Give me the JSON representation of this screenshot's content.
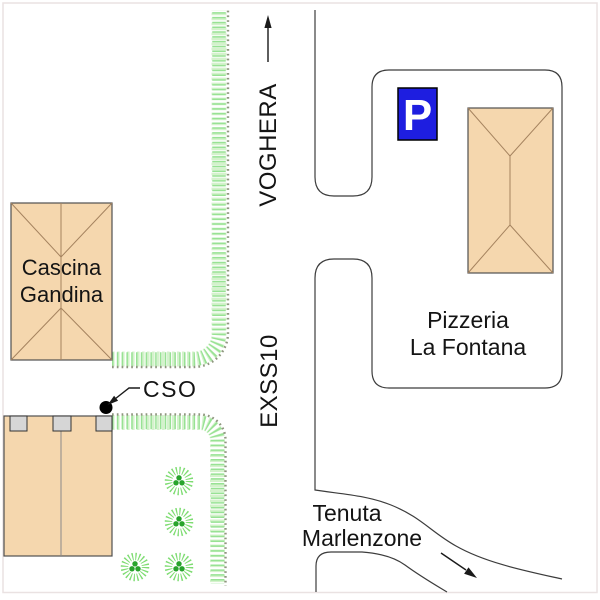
{
  "map": {
    "labels": {
      "road_main": "VOGHERA",
      "road_secondary": "EXSS10",
      "farm_line1": "Cascina",
      "farm_line2": "Gandina",
      "pizzeria_line1": "Pizzeria",
      "pizzeria_line2": "La Fontana",
      "estate_line1": "Tenuta",
      "estate_line2": "Marlenzone",
      "cso_marker": "CSO",
      "parking_sign": "P"
    },
    "colors": {
      "building_fill": "#f5d7ae",
      "building_stroke": "#4f4f4f",
      "roof_line": "#a5835f",
      "hedge_green": "#98e294",
      "hedge_dots": "#8f977f",
      "bush_ring": "#7edc72",
      "bush_center": "#28a42c",
      "parking_blue": "#1e1ee0",
      "chimney_fill": "#d6d6d6",
      "road_line": "#3c3c3c",
      "text": "#141414"
    }
  }
}
